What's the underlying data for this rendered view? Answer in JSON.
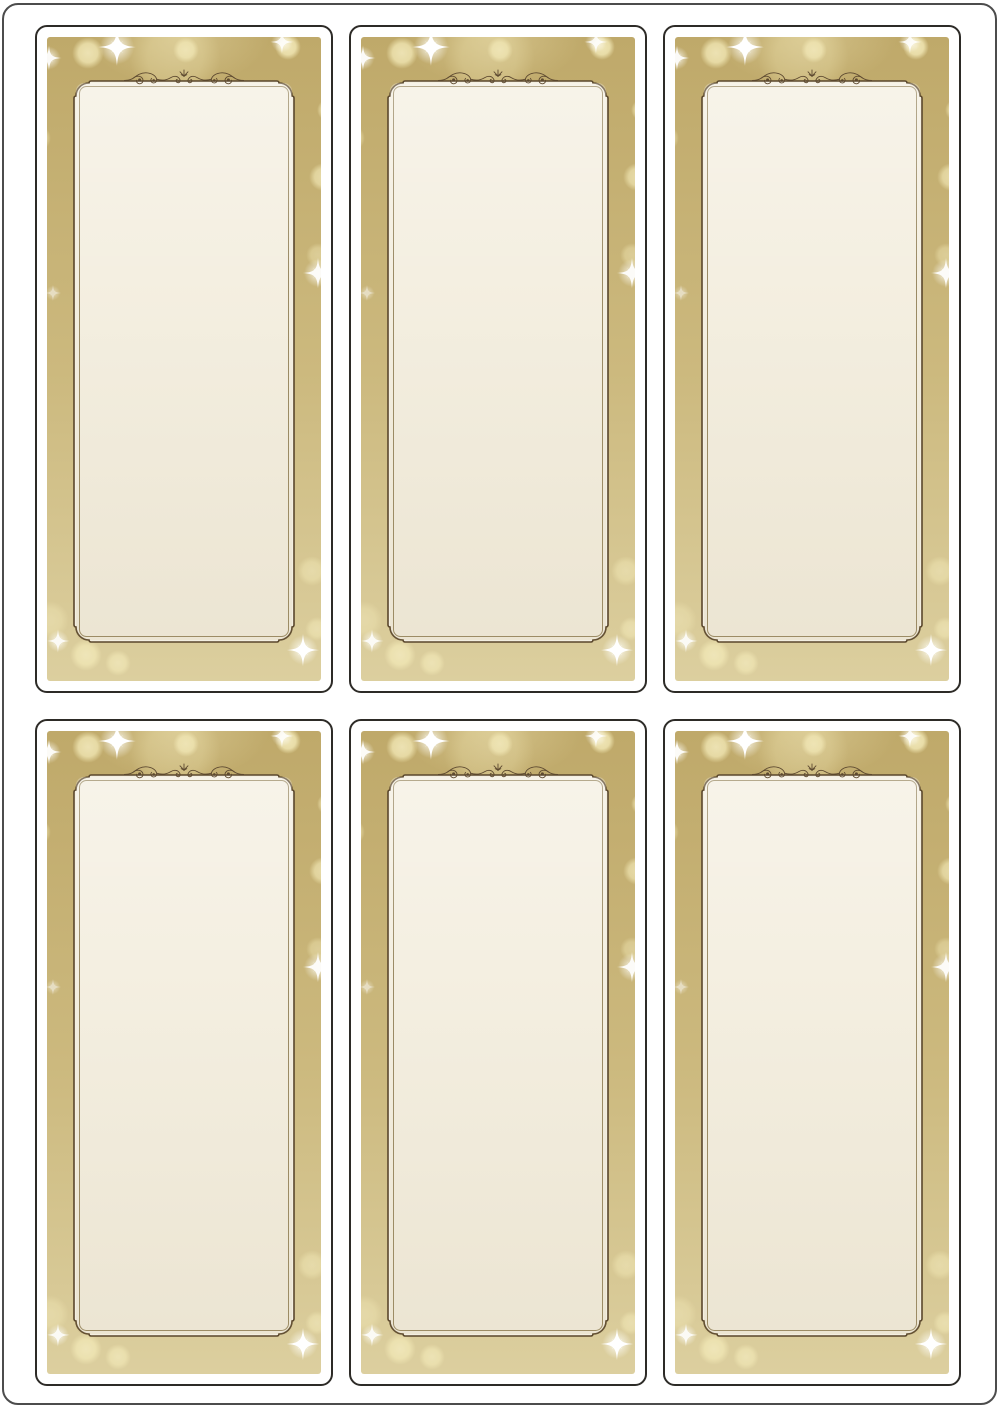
{
  "sheet": {
    "rows": 2,
    "columns": 3,
    "label_count": 6,
    "label_width_px": 298,
    "label_height_px": 668,
    "column_gap_px": 16,
    "row_gap_px": 26
  },
  "theme": {
    "page_background": "#ffffff",
    "page_border": "#4c4c4c",
    "label_outline": "#2d2b27",
    "label_margin": "#ffffff",
    "gold_top": "#bfa96a",
    "gold_mid": "#ccb97e",
    "gold_bottom": "#dccf9f",
    "panel_fill": "#f4efe1",
    "panel_border": "#5a472c",
    "panel_inner_line": "#9a8a64",
    "flourish": "#5d4930",
    "bokeh": "#f5ecba",
    "sparkle": "#ffffff"
  },
  "icons": {
    "ornament": "scroll-flourish",
    "sparkle": "four-point-star",
    "bokeh": "soft-glow-circle"
  },
  "decorations": {
    "bokeh": [
      {
        "x": 41,
        "y": 16,
        "r": 16,
        "a": 0.85
      },
      {
        "x": 139,
        "y": 13,
        "r": 13,
        "a": 0.75
      },
      {
        "x": 241,
        "y": 10,
        "r": 13,
        "a": 0.9
      },
      {
        "x": 281,
        "y": 73,
        "r": 11,
        "a": 0.8
      },
      {
        "x": -9,
        "y": 101,
        "r": 13,
        "a": 0.7
      },
      {
        "x": 276,
        "y": 140,
        "r": 14,
        "a": 0.7
      },
      {
        "x": 271,
        "y": 218,
        "r": 12,
        "a": 0.45
      },
      {
        "x": 68,
        "y": 258,
        "r": 16,
        "a": 0.28
      },
      {
        "x": 128,
        "y": 20,
        "r": 46,
        "a": 0.28
      },
      {
        "x": 3,
        "y": 583,
        "r": 19,
        "a": 0.4
      },
      {
        "x": 39,
        "y": 618,
        "r": 16,
        "a": 0.75
      },
      {
        "x": 71,
        "y": 626,
        "r": 13,
        "a": 0.65
      },
      {
        "x": 265,
        "y": 534,
        "r": 15,
        "a": 0.5
      },
      {
        "x": 270,
        "y": 592,
        "r": 12,
        "a": 0.55
      }
    ],
    "sparkles": [
      {
        "x": 70,
        "y": 10,
        "size": 21,
        "o": 1.0
      },
      {
        "x": 2,
        "y": 21,
        "size": 14,
        "o": 0.95
      },
      {
        "x": 235,
        "y": 5,
        "size": 13,
        "o": 0.9
      },
      {
        "x": 271,
        "y": 236,
        "size": 17,
        "o": 0.95
      },
      {
        "x": 6,
        "y": 256,
        "size": 9,
        "o": 0.55
      },
      {
        "x": 11,
        "y": 604,
        "size": 13,
        "o": 0.9
      },
      {
        "x": 256,
        "y": 613,
        "size": 18,
        "o": 1.0
      }
    ]
  }
}
